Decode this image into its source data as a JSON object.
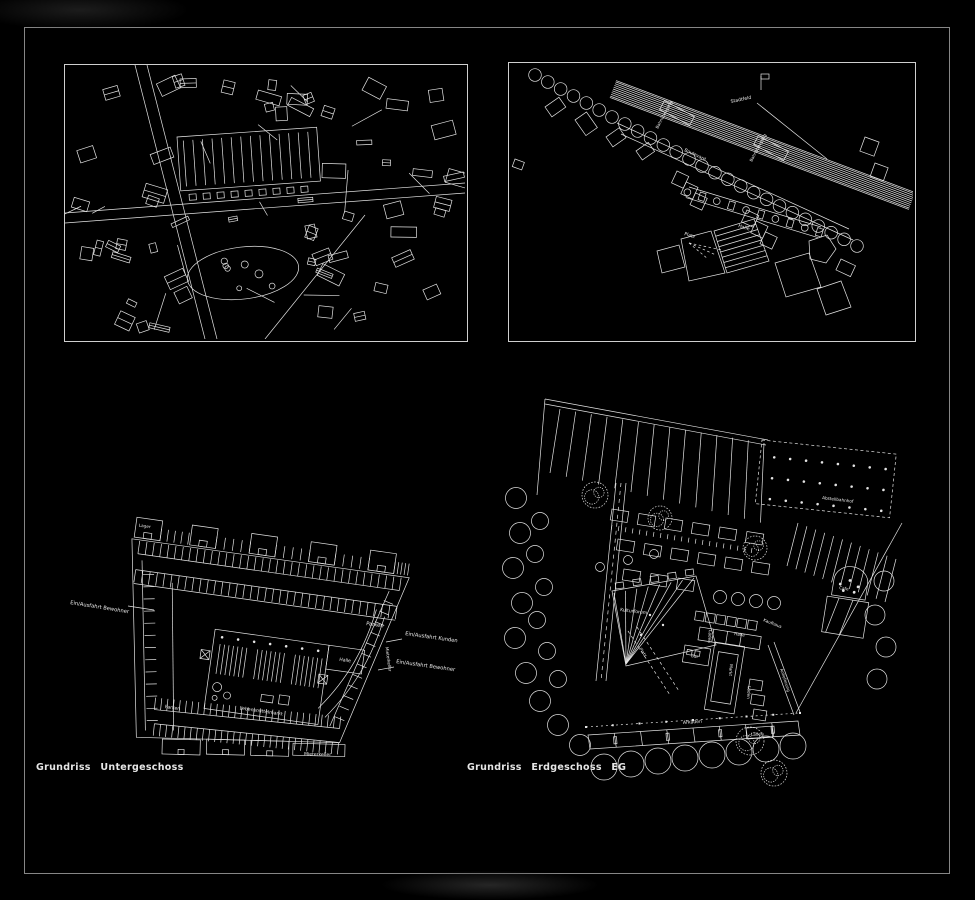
{
  "board": {
    "background": "#000000",
    "ink": "#e4e4e4",
    "frame": "#a8a8a8"
  },
  "site_plan": {
    "labels": {
      "stadtfeld": "Stadtfeld",
      "crossing_left": "Bahnübergang",
      "crossing_right": "Bahnübergang",
      "boulevard": "Boulevard",
      "platz": "Platz",
      "halle": "Halle"
    }
  },
  "basement_plan": {
    "caption": "Grundriss Untergeschoss",
    "labels": {
      "lager": "Lager",
      "ein_ausfahrt_bewohner_left": "Ein/Ausfahrt Bewohner",
      "parken_right": "Parken",
      "ein_ausfahrt_kunden": "Ein/Ausfahrt Kunden",
      "ein_ausfahrt_bewohner_right": "Ein/Ausfahrt Bewohner",
      "halle": "Halle",
      "lebensmittelmarkt": "Lebensmittelmarkt",
      "parken_left": "Parken",
      "mieterkeller_box": "Mieterkeller",
      "mieterkeller_edge": "Mieterkeller"
    }
  },
  "ground_floor_plan": {
    "caption": "Grundriss Erdgeschoss EG",
    "labels": {
      "abstellbahnhof": "Abstellbahnhof",
      "kulturforum": "Kulturforum",
      "kaufhaus": "Kaufhaus",
      "halle": "Halle",
      "laeden_mid": "Läden",
      "bar": "Bar",
      "markt": "Markt",
      "laeden_right": "Läden",
      "anlieferung": "Anlieferung",
      "platz": "Platz",
      "cafe": "Cafe",
      "arkaden": "Arkaden",
      "laeden_bottom": "Läden"
    }
  }
}
